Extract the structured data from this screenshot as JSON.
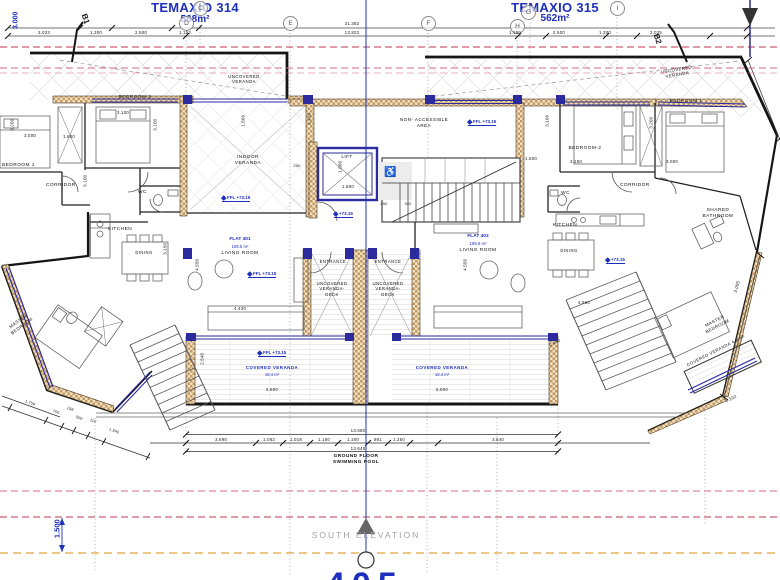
{
  "plots": {
    "left_name": "TEMAXIO 314",
    "left_area": "568m²",
    "right_name": "TEMAXIO 315",
    "right_area": "562m²"
  },
  "grid": {
    "c": "C",
    "d": "D",
    "e": "E",
    "f": "F",
    "g": "G",
    "h": "H",
    "i": "I",
    "b1": "B1",
    "b2": "B2"
  },
  "levels": {
    "ffl_full": "FFL +73.15",
    "ffl_short": "+73.15"
  },
  "icons": {
    "wheelchair": "♿",
    "ffl_marker": "diamond",
    "section_arrow": "triangle"
  },
  "flats": {
    "f401_name": "FLAT 401",
    "f401_area": "109.5 m²",
    "f402_name": "FLAT 402",
    "f402_area": "109.5 m²"
  },
  "rooms": {
    "l_bedroom2": "BEDROOM 2",
    "l_bedroom1": "BEDROOM 1",
    "l_corridor": "CORRIDOR",
    "l_wc": "WC",
    "l_kitchen": "KITCHEN",
    "l_dining": "DINING",
    "l_indoor_veranda": "INDOOR\nVERANDA",
    "l_living": "LIVING ROOM",
    "l_master": "MASTER\nBEDROOM",
    "r_bedroom1": "BEDROOM 1",
    "r_bedroom2": "BEDROOM-2",
    "r_corridor": "CORRIDOR",
    "r_wc": "WC",
    "r_kitchen": "KITCHEN",
    "r_dining": "DINING",
    "r_living": "LIVING ROOM",
    "r_shared_bath": "SHARED\nBATHROOM",
    "r_master": "MASTER\nBEDROOM",
    "r_covered_veranda": "COVERED VERANDA",
    "r_covered_veranda_area": "4.9 m²",
    "lift": "LIFT",
    "non_accessible": "NON- ACCESSIBLE\nAREA",
    "entrance": "ENTRANCE",
    "veranda_deck": "UNCOVERED\nVERANDA-\nDECK",
    "uncovered_veranda": "UNCOVERED\nVERANDA",
    "covered_veranda": "COVERED VERANDA",
    "covered_veranda_area": "18.4 m²"
  },
  "dims": {
    "top_left": [
      "3.023",
      "1.300",
      "2.500",
      "1.152"
    ],
    "top_right": [
      "1.150",
      "2.500",
      "1.300",
      "3.025"
    ],
    "total_top": "31.382",
    "total_mid": "13.823",
    "left_edge": "3.000",
    "core_w": "1.910",
    "core_lift_h": "1.800",
    "core_lift_w": "1.800",
    "core_a": "850",
    "core_b": "920",
    "core_c": "250",
    "lf": [
      "3.100",
      "3.100",
      "3.000",
      "1.600",
      "3.200",
      "5.100",
      "1.600",
      "4.430",
      "4.550",
      "3.150",
      "2.540",
      "6.800"
    ],
    "rf": [
      "1.600",
      "3.150",
      "3.000",
      "3.100",
      "3.200",
      "4.560",
      "4.550",
      "2.440",
      "3.095",
      "3.102",
      "6.800"
    ],
    "bottom_chain": [
      "3.690",
      "1.082",
      "1.018",
      "1.100",
      "1.100",
      "891",
      "1.260",
      "3.540"
    ],
    "bottom_total_top": "13.680",
    "bottom_total_bot": "13.648",
    "diag": [
      "1.758",
      "700",
      "158",
      "500",
      "110",
      "1.940"
    ],
    "south_gap": "1.500"
  },
  "footer": {
    "ground_floor": "GROUND FLOOR\nSWIMMING POOL",
    "south_elevation": "SOUTH ELEVATION",
    "sheet_no": "405"
  }
}
